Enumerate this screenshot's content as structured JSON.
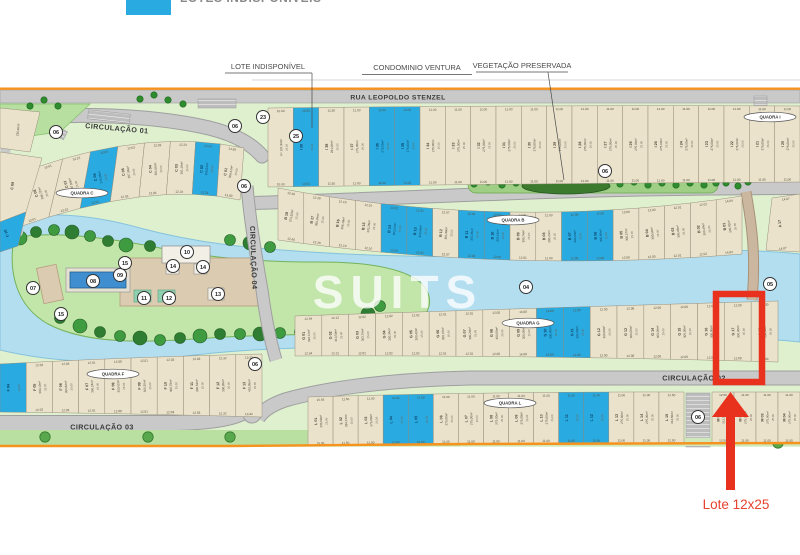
{
  "legend": {
    "label": "LOTES INDISPONÍVEIS",
    "swatch_color": "#29abe2"
  },
  "annotations": {
    "lote": "LOTE INDISPONÍVEL",
    "ventura": "CONDOMINIO VENTURA",
    "vegetacao": "VEGETAÇÃO PRESERVADA"
  },
  "streets": {
    "rua": "RUA LEOPOLDO STENZEL",
    "c01": "CIRCULAÇÃO 01",
    "c02": "CIRCULAÇÃO 02",
    "c03": "CIRCULAÇÃO 03",
    "c04": "CIRCULAÇÃO 04"
  },
  "watermark": {
    "name": "SUITS",
    "sub": "I M Ó V E I S"
  },
  "highlight": {
    "label": "Lote 12x25",
    "color": "#e8321e"
  },
  "colors": {
    "unavailable_blue": "#29abe2",
    "lot_beige": "#eae2ca",
    "water": "#b2def0",
    "orange_boundary": "#f6921e"
  },
  "ovals": [
    {
      "name": "QUADRA C",
      "x": 82,
      "y": 193
    },
    {
      "name": "QUADRA F",
      "x": 113,
      "y": 374
    },
    {
      "name": "QUADRA B",
      "x": 513,
      "y": 220
    },
    {
      "name": "QUADRA G",
      "x": 528,
      "y": 323
    },
    {
      "name": "QUADRA I",
      "x": 770,
      "y": 117
    },
    {
      "name": "QUADRA L",
      "x": 510,
      "y": 403
    }
  ],
  "markers": [
    {
      "n": "06",
      "x": 56,
      "y": 132
    },
    {
      "n": "06",
      "x": 235,
      "y": 126
    },
    {
      "n": "23",
      "x": 263,
      "y": 117
    },
    {
      "n": "25",
      "x": 296,
      "y": 136
    },
    {
      "n": "06",
      "x": 244,
      "y": 186
    },
    {
      "n": "06",
      "x": 605,
      "y": 171
    },
    {
      "n": "05",
      "x": 770,
      "y": 284
    },
    {
      "n": "04",
      "x": 526,
      "y": 287
    },
    {
      "n": "07",
      "x": 33,
      "y": 288
    },
    {
      "n": "08",
      "x": 93,
      "y": 281
    },
    {
      "n": "09",
      "x": 120,
      "y": 275
    },
    {
      "n": "15",
      "x": 125,
      "y": 263
    },
    {
      "n": "15",
      "x": 61,
      "y": 314
    },
    {
      "n": "10",
      "x": 187,
      "y": 252
    },
    {
      "n": "14",
      "x": 173,
      "y": 266
    },
    {
      "n": "14",
      "x": 203,
      "y": 267
    },
    {
      "n": "11",
      "x": 144,
      "y": 298
    },
    {
      "n": "12",
      "x": 169,
      "y": 298
    },
    {
      "n": "13",
      "x": 218,
      "y": 294
    },
    {
      "n": "06",
      "x": 255,
      "y": 364
    },
    {
      "n": "06",
      "x": 698,
      "y": 417
    }
  ],
  "extra_lots": [
    {
      "id": "",
      "a": "235,46m²"
    },
    {
      "id": "C 09",
      "a": ""
    },
    {
      "id": "C 10",
      "a": "",
      "blue": true
    },
    {
      "id": "A 17",
      "a": "",
      "w": "14.07"
    }
  ],
  "quadras": [
    {
      "key": "I",
      "name": "QUADRA I",
      "depth": "25.00",
      "lots": [
        {
          "id": "",
          "a": "A= 181,96m²",
          "w": "10.00"
        },
        {
          "id": "I 39",
          "a": "",
          "w": "10.55",
          "blue": true
        },
        {
          "id": "I 38",
          "a": "284,06m²",
          "w": "11.50"
        },
        {
          "id": "I 37",
          "a": "275,00m²",
          "w": "11.00"
        },
        {
          "id": "I 36",
          "a": "275,00m²",
          "w": "11.00",
          "blue": true
        },
        {
          "id": "I 35",
          "a": "275,00m²",
          "w": "11.00",
          "blue": true
        },
        {
          "id": "I 34",
          "a": "275,00m²",
          "w": "11.00"
        },
        {
          "id": "I 33",
          "a": "275,00m²",
          "w": "11.00"
        },
        {
          "id": "I 32",
          "a": "275,00m²",
          "w": "11.00"
        },
        {
          "id": "I 31",
          "a": "275,00m²",
          "w": "11.00"
        },
        {
          "id": "I 30",
          "a": "275,00m²",
          "w": "11.00"
        },
        {
          "id": "I 29",
          "a": "275,00m²",
          "w": "11.00"
        },
        {
          "id": "I 28",
          "a": "275,00m²",
          "w": "11.00"
        },
        {
          "id": "I 27",
          "a": "275,00m²",
          "w": "11.00"
        },
        {
          "id": "I 26",
          "a": "275,00m²",
          "w": "11.00"
        },
        {
          "id": "I 25",
          "a": "275,00m²",
          "w": "11.00"
        },
        {
          "id": "I 24",
          "a": "275,00m²",
          "w": "11.00"
        },
        {
          "id": "I 23",
          "a": "275,00m²",
          "w": "11.00"
        },
        {
          "id": "I 22",
          "a": "275,00m²",
          "w": "11.00"
        },
        {
          "id": "I 21",
          "a": "275,00m²",
          "w": "11.00"
        },
        {
          "id": "I 20",
          "a": "275,00m²",
          "w": "11.00"
        }
      ]
    },
    {
      "key": "C",
      "name": "QUADRA C",
      "depth": "25.00",
      "lots": [
        {
          "id": "C 08",
          "a": "338,72m²",
          "w": "12.61"
        },
        {
          "id": "C 07",
          "a": "307,80m²",
          "w": "12.23"
        },
        {
          "id": "C 06",
          "a": "375,06m²",
          "w": "12.03",
          "blue": true
        },
        {
          "id": "C 05",
          "a": "307,96m²",
          "w": "12.03"
        },
        {
          "id": "C 04",
          "a": "301,08m²",
          "w": "12.03"
        },
        {
          "id": "C 03",
          "a": "301,18m²",
          "w": "12.24"
        },
        {
          "id": "C 02",
          "a": "308,54m²",
          "w": "12.24",
          "blue": true
        },
        {
          "id": "C 01",
          "a": "300,41m²",
          "w": "14.60"
        }
      ]
    },
    {
      "key": "B",
      "name": "QUADRA B",
      "depth": "25.00",
      "lots": [
        {
          "id": "B 18",
          "a": "374,52m²",
          "w": "12.46"
        },
        {
          "id": "B 17",
          "a": "360,34m²",
          "w": "12.28"
        },
        {
          "id": "B 16",
          "a": "306,18m²",
          "w": "12.18"
        },
        {
          "id": "B 15",
          "a": "303,36m²",
          "w": "12.10"
        },
        {
          "id": "B 14",
          "a": "302,04m²",
          "w": "12.02",
          "blue": true
        },
        {
          "id": "B 13",
          "a": "302,66m²",
          "w": "12.02",
          "blue": true
        },
        {
          "id": "B 12",
          "a": "301,68m²",
          "w": "12.07"
        },
        {
          "id": "B 11",
          "a": "301,06m²",
          "w": "12.02",
          "blue": true
        },
        {
          "id": "B 10",
          "a": "301,16m²",
          "w": "12.02",
          "blue": true
        },
        {
          "id": "B 09",
          "a": "300,76m²",
          "w": "12.01"
        },
        {
          "id": "B 08",
          "a": "300,23m²",
          "w": "12.00"
        },
        {
          "id": "B 07",
          "a": "300,04m²",
          "w": "12.00",
          "blue": true
        },
        {
          "id": "B 06",
          "a": "300,86m²",
          "w": "12.00",
          "blue": true
        },
        {
          "id": "B 05",
          "a": "300,27m²",
          "w": "12.00"
        },
        {
          "id": "B 04",
          "a": "300,59m²",
          "w": "12.00"
        },
        {
          "id": "B 03",
          "a": "300,46m²",
          "w": "12.01"
        },
        {
          "id": "B 02",
          "a": "300,49m²",
          "w": "12.02"
        },
        {
          "id": "B 01",
          "a": "300,92m²",
          "w": "14.04"
        }
      ]
    },
    {
      "key": "G",
      "name": "QUADRA G",
      "depth": "25.00",
      "lots": [
        {
          "id": "G 01",
          "a": "394,11m²",
          "w": "12.54"
        },
        {
          "id": "G 02",
          "a": "310,50m²",
          "w": "12.12"
        },
        {
          "id": "G 03",
          "a": "303,76m²",
          "w": "12.02"
        },
        {
          "id": "G 04",
          "a": "300,34m²",
          "w": "12.02"
        },
        {
          "id": "G 05",
          "a": "300,42m²",
          "w": "12.02"
        },
        {
          "id": "G 06",
          "a": "300,37m²",
          "w": "12.01"
        },
        {
          "id": "G 07",
          "a": "300,24m²",
          "w": "12.01"
        },
        {
          "id": "G 08",
          "a": "300,00m²",
          "w": "12.00"
        },
        {
          "id": "G 09",
          "a": "300,00m²",
          "w": "14.00"
        },
        {
          "id": "G 10",
          "a": "300,00m²",
          "w": "14.00",
          "blue": true
        },
        {
          "id": "G 11",
          "a": "300,00m²",
          "w": "12.00",
          "blue": true
        },
        {
          "id": "G 12",
          "a": "300,00m²",
          "w": "12.00"
        },
        {
          "id": "G 13",
          "a": "300,00m²",
          "w": "12.00"
        },
        {
          "id": "G 14",
          "a": "300,00m²",
          "w": "12.00"
        },
        {
          "id": "G 15",
          "a": "300,00m²",
          "w": "12.00"
        },
        {
          "id": "G 16",
          "a": "300,00m²",
          "w": "12.00"
        },
        {
          "id": "G 17",
          "a": "300,00m²",
          "w": "12.00",
          "highlight": true
        },
        {
          "id": "G 18",
          "a": "350,00m²",
          "w": "12.00"
        }
      ]
    },
    {
      "key": "F",
      "name": "QUADRA F",
      "depth": "25.00",
      "lots": [
        {
          "id": "F 04",
          "a": "",
          "w": "",
          "blue": true
        },
        {
          "id": "F 05",
          "a": "300,10m²",
          "w": "12.02"
        },
        {
          "id": "F 06",
          "a": "300,82m²",
          "w": "12.03"
        },
        {
          "id": "F 07",
          "a": "300,24m²",
          "w": "12.01"
        },
        {
          "id": "F 08",
          "a": "300,02m²",
          "w": "12.00"
        },
        {
          "id": "F 09",
          "a": "300,30m²",
          "w": "12.01"
        },
        {
          "id": "F 10",
          "a": "300,78m²",
          "w": "12.03"
        },
        {
          "id": "F 11",
          "a": "300,52m²",
          "w": "12.03"
        },
        {
          "id": "F 12",
          "a": "300,85m²",
          "w": "12.32"
        },
        {
          "id": "F 13",
          "a": "410,86m²",
          "w": "13.32"
        }
      ]
    },
    {
      "key": "Lr",
      "name": "QUADRA L",
      "depth": "25.00",
      "lots": [
        {
          "id": "L 01",
          "a": "335,69m²",
          "w": "15.55"
        },
        {
          "id": "L 02",
          "a": "284,37m²",
          "w": "11.50"
        },
        {
          "id": "L 03",
          "a": "275,00m²",
          "w": "11.00"
        },
        {
          "id": "L 04",
          "a": "",
          "w": "11.00",
          "blue": true
        },
        {
          "id": "L 05",
          "a": "",
          "w": "11.00",
          "blue": true
        },
        {
          "id": "L 06",
          "a": "275,00m²",
          "w": "11.00"
        },
        {
          "id": "L 07",
          "a": "275,00m²",
          "w": "11.00"
        },
        {
          "id": "L 08",
          "a": "275,00m²",
          "w": "11.00"
        },
        {
          "id": "L 09",
          "a": "275,00m²",
          "w": "11.00"
        },
        {
          "id": "L 10",
          "a": "275,00m²",
          "w": "11.00"
        },
        {
          "id": "L 11",
          "a": "",
          "w": "11.00",
          "blue": true
        },
        {
          "id": "L 12",
          "a": "",
          "w": "11.00",
          "blue": true
        },
        {
          "id": "L 13",
          "a": "275,00m²",
          "w": "11.00"
        },
        {
          "id": "L 14",
          "a": "275,00m²",
          "w": "11.00"
        },
        {
          "id": "L 15",
          "a": "312,50m²",
          "w": "12.50"
        }
      ]
    },
    {
      "key": "M",
      "name": "QUADRA M",
      "depth": "25.00",
      "lots": [
        {
          "id": "M 01",
          "a": "312,50m²",
          "w": "12.50"
        },
        {
          "id": "M 02",
          "a": "275,00m²",
          "w": "11.00"
        },
        {
          "id": "M 03",
          "a": "275,00m²",
          "w": "11.00"
        },
        {
          "id": "M 04",
          "a": "275,00m²",
          "w": "11.00"
        }
      ]
    }
  ]
}
